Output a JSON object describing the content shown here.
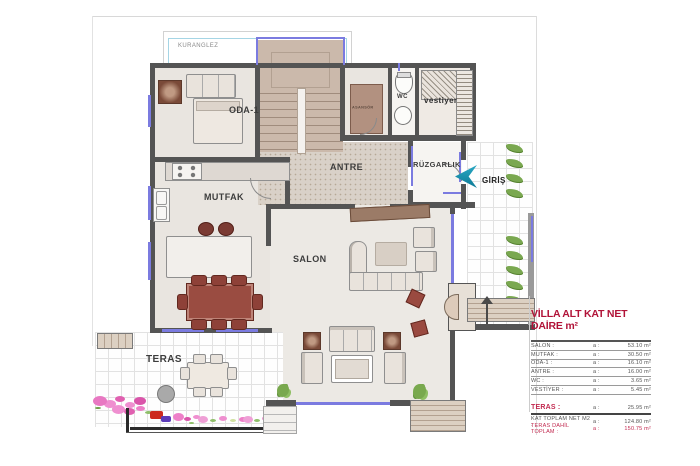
{
  "rooms": {
    "kuranglez": "KURANGLEZ",
    "oda1": "ODA-1",
    "mutfak": "MUTFAK",
    "antre": "ANTRE",
    "ruzgarlik": "RÜZGARLIK",
    "giris": "GİRİŞ",
    "salon": "SALON",
    "teras": "TERAS",
    "wc": "WC",
    "asansor": "ASANSÖR",
    "vestiyer": "vestiyer"
  },
  "legend": {
    "title": "VİLLA ALT KAT NET DAİRE m²",
    "rows": [
      {
        "label": "SALON :",
        "prefix": "a :",
        "value": "53.10 m²"
      },
      {
        "label": "MUTFAK :",
        "prefix": "a :",
        "value": "30.50 m²"
      },
      {
        "label": "ODA-1 :",
        "prefix": "a :",
        "value": "16.10 m²"
      },
      {
        "label": "ANTRE :",
        "prefix": "a :",
        "value": "16.00 m²"
      },
      {
        "label": "WC :",
        "prefix": "a :",
        "value": "3.65 m²"
      },
      {
        "label": "VESTİYER :",
        "prefix": "a :",
        "value": "5.45 m²"
      }
    ],
    "teras_row": {
      "label": "TERAS :",
      "prefix": "a :",
      "value": "25.95 m²"
    },
    "total_net": {
      "label": "KAT TOPLAM NET M2 :",
      "prefix": "a :",
      "value": "124.80 m²"
    },
    "total_full": {
      "label": "TERAS DAHİL TOPLAM :",
      "prefix": "a :",
      "value": "150.75 m²"
    }
  },
  "icons": {
    "entry_arrow": "chevron-left",
    "stair_direction": "arrow-up"
  },
  "colors": {
    "wall": "#545454",
    "window_blue": "#7b7be0",
    "legend_red": "#b11338",
    "entry_teal": "#1792b0",
    "stair_tan": "#c8b4a6",
    "table_red": "#9a4c41",
    "plant_green": "#79a94e",
    "flower_pink": "#e878c2"
  }
}
